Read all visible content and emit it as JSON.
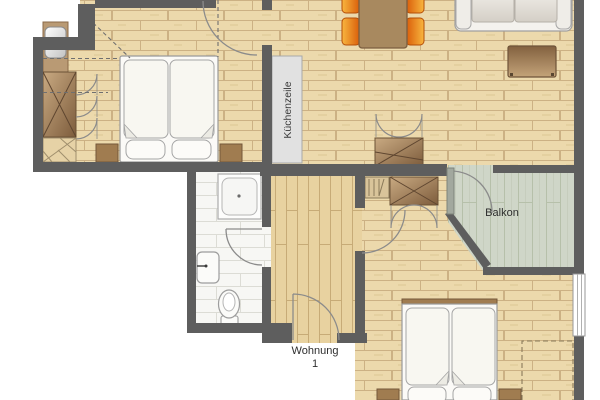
{
  "plan": {
    "labels": {
      "kitchen_unit": "Küchenzeile",
      "balcony": "Balkon",
      "apartment_line1": "Wohnung",
      "apartment_line2": "1"
    },
    "colors": {
      "wall": "#5e5e5e",
      "wood_floor": "#ecd9ac",
      "wood_floor_line": "#ccb184",
      "hallway_floor": "#e8d2a0",
      "balcony_deck": "#cfd6c8",
      "bathroom_floor": "#f7f7f4",
      "furniture_wood": "#8a684a",
      "chair_orange": "#e8650d",
      "kitchen_counter": "#e1e1e1"
    }
  }
}
